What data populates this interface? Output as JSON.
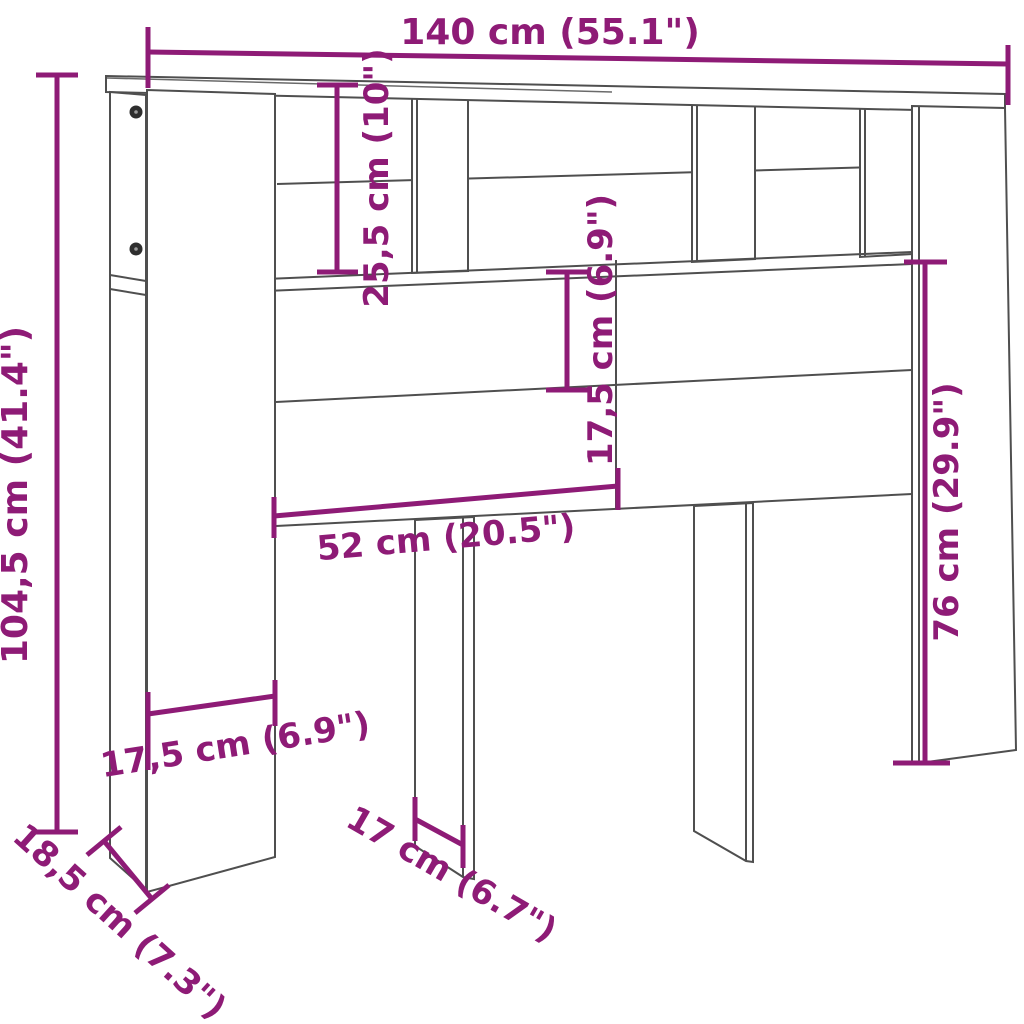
{
  "diagram": {
    "type": "furniture-dimension-diagram",
    "product": "headboard-cabinet",
    "colors": {
      "accent": "#8e1b76",
      "line": "#4f4f4f",
      "background": "#ffffff",
      "screw": "#2e2e2e"
    },
    "dimensions": {
      "overall_width": {
        "cm": "140",
        "inch": "55.1",
        "label": "140 cm (55.1\")"
      },
      "overall_height": {
        "cm": "104,5",
        "inch": "41.4",
        "label": "104,5 cm (41.4\")"
      },
      "shelf_height": {
        "cm": "25,5",
        "inch": "10",
        "label": "25,5 cm (10\")"
      },
      "panel_height": {
        "cm": "17,5",
        "inch": "6.9",
        "label": "17,5 cm (6.9\")"
      },
      "center_span": {
        "cm": "52",
        "inch": "20.5",
        "label": "52 cm (20.5\")"
      },
      "leg_height": {
        "cm": "76",
        "inch": "29.9",
        "label": "76 cm (29.9\")"
      },
      "partition_width": {
        "cm": "17,5",
        "inch": "6.9",
        "label": "17,5 cm (6.9\")"
      },
      "base_depth": {
        "cm": "18,5",
        "inch": "7.3",
        "label": "18,5 cm (7.3\")"
      },
      "leg_depth": {
        "cm": "17",
        "inch": "6.7",
        "label": "17 cm (6.7\")"
      }
    }
  }
}
